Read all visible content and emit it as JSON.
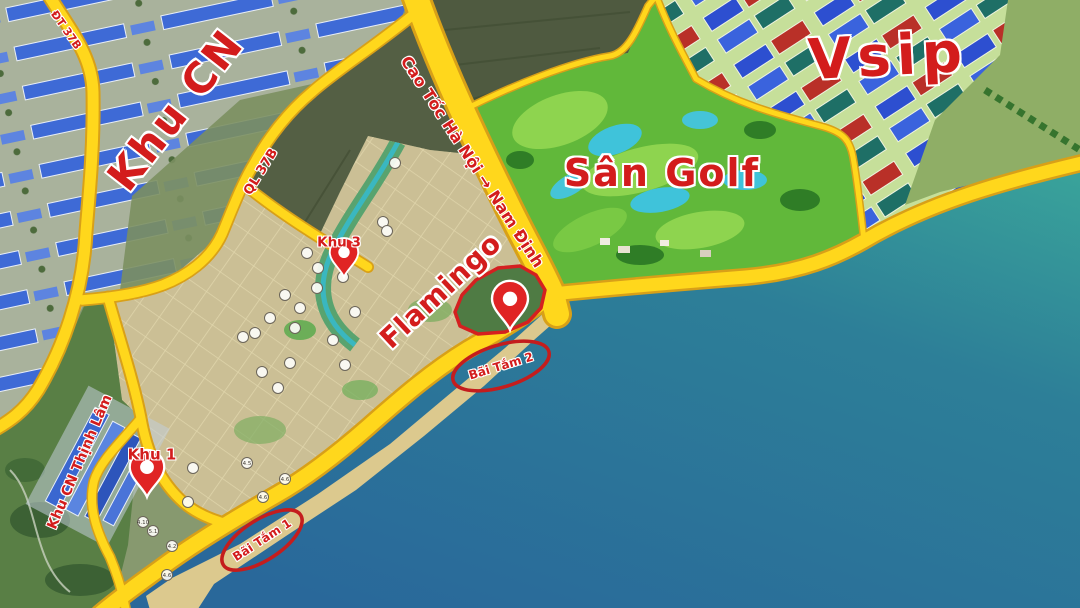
{
  "map": {
    "title": "Master plan map - coastal industrial and resort zones",
    "region_labels": [
      {
        "id": "khu-cn",
        "text": "Khu CN"
      },
      {
        "id": "vsip",
        "text": "Vsip"
      },
      {
        "id": "san-golf",
        "text": "Sân Golf"
      },
      {
        "id": "flamingo",
        "text": "Flamingo"
      },
      {
        "id": "thinh-lam",
        "text": "Khu CN Thịnh Lâm"
      }
    ],
    "road_labels": [
      {
        "id": "cao-toc",
        "text": "Cao Tốc Hà Nội → Nam Định"
      },
      {
        "id": "ql-37b",
        "text": "QL 37B"
      },
      {
        "id": "dt",
        "text": "ĐT 37B"
      }
    ],
    "point_labels": [
      {
        "id": "khu-3",
        "text": "Khu 3"
      },
      {
        "id": "khu-1",
        "text": "Khu 1"
      }
    ],
    "beach_labels": [
      {
        "id": "bai-tam-2",
        "text": "Bãi Tắm 2"
      },
      {
        "id": "bai-tam-1",
        "text": "Bãi Tắm 1"
      }
    ],
    "lot_markers": [
      {
        "x": 395,
        "y": 163,
        "label": ""
      },
      {
        "x": 383,
        "y": 222,
        "label": ""
      },
      {
        "x": 387,
        "y": 231,
        "label": ""
      },
      {
        "x": 307,
        "y": 253,
        "label": ""
      },
      {
        "x": 318,
        "y": 268,
        "label": ""
      },
      {
        "x": 343,
        "y": 277,
        "label": ""
      },
      {
        "x": 355,
        "y": 312,
        "label": ""
      },
      {
        "x": 333,
        "y": 340,
        "label": ""
      },
      {
        "x": 285,
        "y": 295,
        "label": ""
      },
      {
        "x": 317,
        "y": 288,
        "label": ""
      },
      {
        "x": 300,
        "y": 308,
        "label": ""
      },
      {
        "x": 270,
        "y": 318,
        "label": ""
      },
      {
        "x": 255,
        "y": 333,
        "label": ""
      },
      {
        "x": 243,
        "y": 337,
        "label": ""
      },
      {
        "x": 295,
        "y": 328,
        "label": ""
      },
      {
        "x": 345,
        "y": 365,
        "label": ""
      },
      {
        "x": 290,
        "y": 363,
        "label": ""
      },
      {
        "x": 262,
        "y": 372,
        "label": ""
      },
      {
        "x": 278,
        "y": 388,
        "label": ""
      },
      {
        "x": 247,
        "y": 463,
        "label": "4.5"
      },
      {
        "x": 285,
        "y": 479,
        "label": "4.6"
      },
      {
        "x": 263,
        "y": 497,
        "label": "4.6"
      },
      {
        "x": 143,
        "y": 522,
        "label": "4.10"
      },
      {
        "x": 153,
        "y": 531,
        "label": "5.1"
      },
      {
        "x": 172,
        "y": 546,
        "label": "4.2"
      },
      {
        "x": 167,
        "y": 575,
        "label": "4.6"
      },
      {
        "x": 193,
        "y": 468,
        "label": ""
      },
      {
        "x": 188,
        "y": 502,
        "label": ""
      }
    ],
    "colors": {
      "road_yellow": "#ffd71c",
      "road_casing": "#d8a018",
      "label_red": "#d31c1c",
      "pin_red": "#e02424",
      "sea_deep": "#29689a",
      "sea_teal": "#38a399",
      "golf_green": "#61b83a",
      "plan_tan": "#cbbf95",
      "building_blue": "#2d4fd0",
      "building_red": "#b93028",
      "beach_sand": "#dcc98e"
    }
  }
}
